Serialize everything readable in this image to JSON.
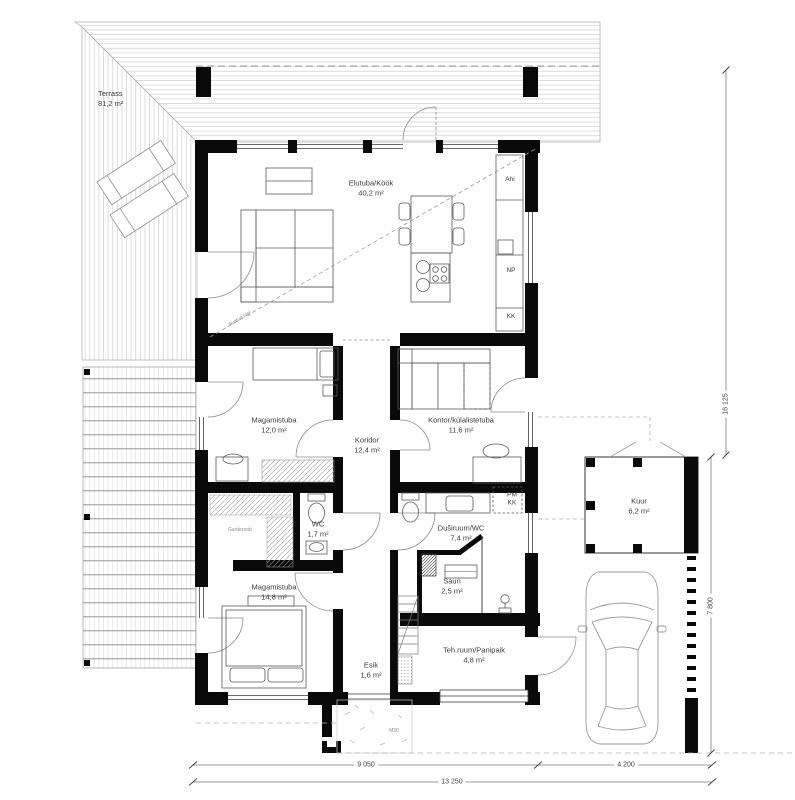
{
  "rooms": {
    "terrass": {
      "name": "Terrass",
      "area": "81,2 m²"
    },
    "elutuba_kook": {
      "name": "Elutuba/Köök",
      "area": "40,2 m²"
    },
    "magamistuba_1": {
      "name": "Magamistuba",
      "area": "12,0 m²"
    },
    "koridor": {
      "name": "Koridor",
      "area": "12,4 m²"
    },
    "kontor_kylalistetuba": {
      "name": "Kontor/külalistetuba",
      "area": "11,6 m²"
    },
    "wc": {
      "name": "WC",
      "area": "1,7 m²"
    },
    "dusiruum_wc": {
      "name": "Duširuum/WC",
      "area": "7,4 m²"
    },
    "saun": {
      "name": "Saun",
      "area": "2,5 m²"
    },
    "magamistuba_2": {
      "name": "Magamistuba",
      "area": "14,8 m²"
    },
    "esik": {
      "name": "Esik",
      "area": "1,6 m²"
    },
    "teh_ruum_panipaik": {
      "name": "Teh.ruum/Panipaik",
      "area": "4,8 m²"
    },
    "kuur": {
      "name": "Kuur",
      "area": "6,2 m²"
    },
    "garderoob": {
      "name": "Garderoob"
    }
  },
  "kitchen_labels": {
    "ahi": "Ahi",
    "np": "NP",
    "kk": "KK"
  },
  "utility_labels": {
    "pm": "PM",
    "kk": "KK"
  },
  "annotations": {
    "avatud_lagi": "Avatud lagi",
    "paving_mark": "M30"
  },
  "dimensions": {
    "bottom_left": "9 050",
    "bottom_right": "4 200",
    "bottom_total": "13 250",
    "right_upper": "16 125",
    "right_lower": "7 800"
  },
  "colors": {
    "wall": "#0a0a0a",
    "line_light": "#bfbfbf",
    "line_mid": "#666666",
    "text": "#3a3a3a"
  }
}
